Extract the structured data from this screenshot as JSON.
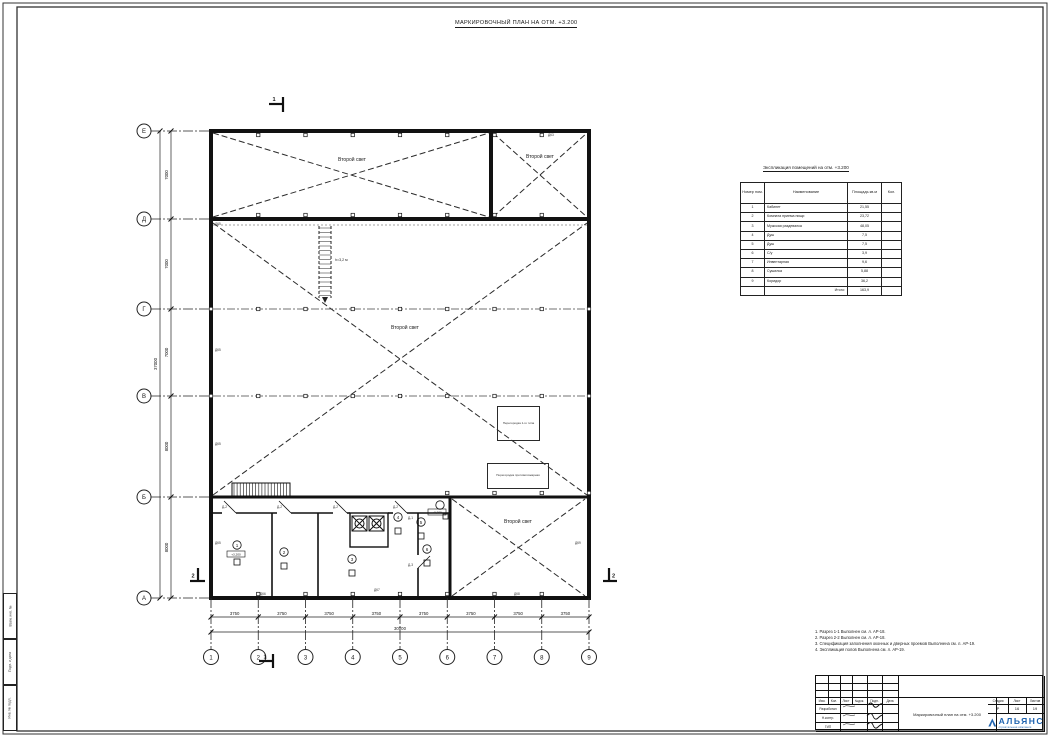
{
  "title": "МАРКИРОВОЧНЫЙ ПЛАН НА ОТМ. +3.200",
  "plan": {
    "second_light": "Второй свет",
    "ladder_note": "h=3,2 м",
    "box_note_1": "Перегородка 1-го типа",
    "box_note_2": "Перегородка противопожарная",
    "section_1": "1",
    "section_2": "2",
    "level_tag": "+3,200",
    "row_axes": [
      "Е",
      "Д",
      "Г",
      "В",
      "Б",
      "А"
    ],
    "row_dims": [
      "7000",
      "7000",
      "7000",
      "8000",
      "8000"
    ],
    "row_total": "37000",
    "col_axes": [
      "1",
      "2",
      "3",
      "4",
      "5",
      "6",
      "7",
      "8",
      "9"
    ],
    "col_dims": [
      "3750",
      "3750",
      "3750",
      "3750",
      "3750",
      "3750",
      "3750",
      "3750"
    ],
    "col_total": "30000",
    "wall_tags": {
      "dk3": "ДК3",
      "dk5": "ДК5",
      "dk6": "ДК6",
      "dk7": "ДК7",
      "dk8": "ДК8",
      "dk9": "ДК9"
    },
    "door_tags": {
      "d1": "Д-1",
      "d2": "Д-2",
      "d3": "Д-3"
    },
    "room_marks": [
      "1",
      "2",
      "3",
      "4",
      "5",
      "6"
    ]
  },
  "table": {
    "title": "Экспликация помещений на отм. +3.200",
    "headers": [
      "Номер пом.",
      "Наименование",
      "Площадь кв.м",
      "Кол."
    ],
    "rows": [
      [
        "1",
        "Кабинет",
        "21,55",
        ""
      ],
      [
        "2",
        "Комната приема пищи",
        "23,72",
        ""
      ],
      [
        "3",
        "Мужская раздевалка",
        "48,05",
        ""
      ],
      [
        "4",
        "Душ",
        "7,5",
        ""
      ],
      [
        "5",
        "Душ",
        "7,5",
        ""
      ],
      [
        "6",
        "С/у",
        "3,9",
        ""
      ],
      [
        "7",
        "Инвентарная",
        "9,6",
        ""
      ],
      [
        "8",
        "Сушилка",
        "5,88",
        ""
      ],
      [
        "9",
        "Коридор",
        "36,2",
        ""
      ],
      [
        "",
        "Итого:",
        "163,9",
        ""
      ]
    ]
  },
  "notes": {
    "line1": "1. Разрез 1-1 Выполнен см. л. АР-18.",
    "line2": "2. Разрез 2-2 Выполнен см. л. АР-18.",
    "line3": "3. Спецификация заполнения оконных и дверных проемов Выполнена см. л. АР-19.",
    "line4": "4. Экспликация полов Выполнена см. л. АР-19."
  },
  "titleblock": {
    "header_cols": [
      "Изм.",
      "Кол.",
      "Лист",
      "№док.",
      "Подп.",
      "Дата"
    ],
    "roles": [
      "Разработал",
      "Н.контр.",
      "ГИП"
    ],
    "stage_label": "Стадия",
    "sheet_label": "Лист",
    "sheets_label": "Листов",
    "stage": "Р",
    "sheet_no": "16",
    "sheets_total": "19",
    "doc_title": "Маркировочный план на отм. +3.200",
    "company": "АЛЬЯНС",
    "company_sub": "строительная компания",
    "accent": "#1e63b0"
  },
  "side_strip": [
    "Взам. инв. №",
    "Подп. и дата",
    "Инв. № подл."
  ]
}
